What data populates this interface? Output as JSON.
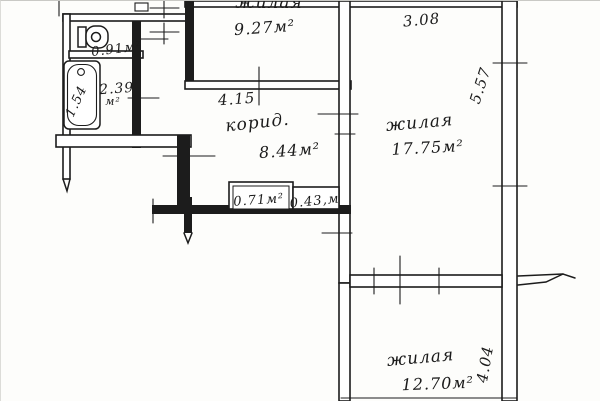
{
  "plan_title": "apartment floor plan (BTI style scan)",
  "colors": {
    "ink": "#1c1c1c",
    "paper": "#ffffff"
  },
  "rooms": {
    "top": {
      "name": "жилая",
      "area": "9.27м²"
    },
    "right": {
      "name": "жилая",
      "area": "17.75м²"
    },
    "bottom": {
      "name": "жилая",
      "area": "12.70м²"
    },
    "corridor": {
      "name": "корид.",
      "area": "8.44м²"
    },
    "wc": {
      "area": "0.91м²"
    },
    "bath": {
      "area": "2.39",
      "unit": "м²"
    },
    "closet1": {
      "area": "0.71м²"
    },
    "closet2": {
      "area": "0.43,м"
    }
  },
  "dimensions": {
    "corridor_width": "4.15",
    "right_room_width": "3.08",
    "right_room_height": "5.57",
    "bottom_room_height": "4.04",
    "bathtub": "1.54"
  }
}
